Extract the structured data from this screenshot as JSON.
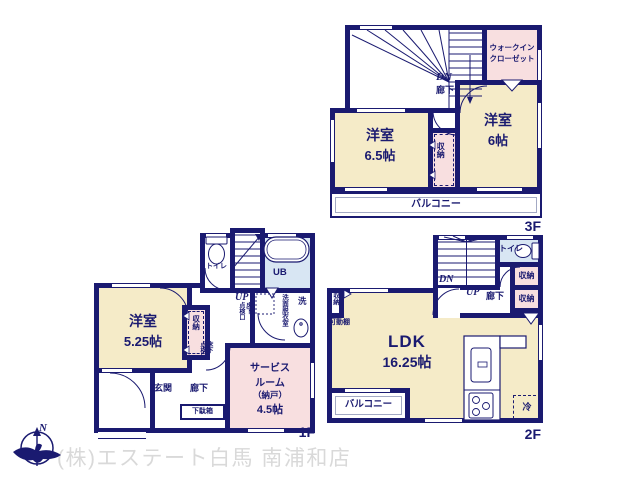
{
  "colors": {
    "wall_navy": "#1a1a70",
    "room_cream": "#f5ebc8",
    "closet_pink": "#f8dfe0",
    "bath_blue": "#d8e6f3",
    "company_gray": "#d9d9d9"
  },
  "branding": {
    "company": "(株)エステート白馬 南浦和店",
    "north": "N"
  },
  "floors": {
    "f3": {
      "label": "3F",
      "room_a_name": "洋室",
      "room_a_size": "6.5帖",
      "room_b_name": "洋室",
      "room_b_size": "6帖",
      "wic_line1": "ウォークイン",
      "wic_line2": "クローゼット",
      "closet": "収納",
      "balcony": "バルコニー",
      "stairs_dn": "DN",
      "hallway": "廊下"
    },
    "f2": {
      "label": "2F",
      "ldk_name": "LDK",
      "ldk_size": "16.25帖",
      "toilet": "トイレ",
      "closet_upper": "収納",
      "closet_lower": "収納",
      "closet_left": "収納",
      "movable_shelf": "可動棚",
      "hallway": "廊下",
      "balcony": "バルコニー",
      "fridge": "冷",
      "stairs_dn": "DN",
      "stairs_up": "UP"
    },
    "f1": {
      "label": "1F",
      "room_name": "洋室",
      "room_size": "5.25帖",
      "service_lines": [
        "サービス",
        "ルーム",
        "（納戸）",
        "4.5帖"
      ],
      "toilet": "トイレ",
      "bath": "UB",
      "stairs_up": "UP",
      "washroom": "洗面脱衣室",
      "laundry": "洗",
      "underfloor_r": "床下",
      "underfloor_l": "点検口",
      "closet": "収納",
      "entrance": "玄関",
      "hallway": "廊下",
      "shoe_cabinet": "下駄箱"
    }
  }
}
